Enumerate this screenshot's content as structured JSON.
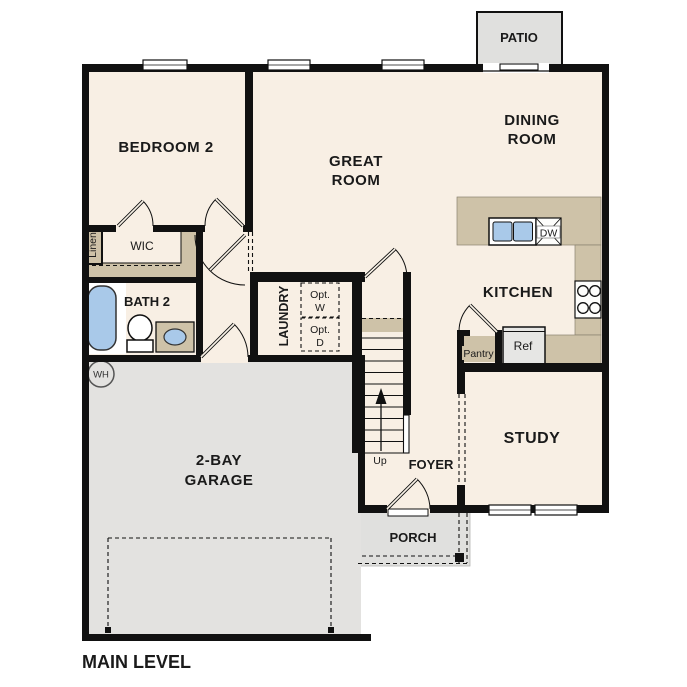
{
  "plan": {
    "title": "MAIN LEVEL",
    "level_count_note": "single visible level"
  },
  "labels": {
    "bedroom2": "BEDROOM 2",
    "great_1": "GREAT",
    "great_2": "ROOM",
    "dining_1": "DINING",
    "dining_2": "ROOM",
    "kitchen": "KITCHEN",
    "study": "STUDY",
    "foyer": "FOYER",
    "porch": "PORCH",
    "patio": "PATIO",
    "garage_1": "2-BAY",
    "garage_2": "GARAGE",
    "bath2": "BATH 2",
    "wic": "WIC",
    "linen": "Linen",
    "laundry": "LAUNDRY",
    "opt_w_1": "Opt.",
    "opt_w_2": "W",
    "opt_d_1": "Opt.",
    "opt_d_2": "D",
    "dw": "DW",
    "ref": "Ref",
    "pantry": "Pantry",
    "up": "Up",
    "wh": "WH",
    "main_level": "MAIN LEVEL"
  },
  "colors": {
    "floor_cream": "#f8efe4",
    "counter_tan": "#cec2a8",
    "garage_gray": "#e3e2e0",
    "outdoor_gray": "#e0e0de",
    "optional_gray": "#d9dddc",
    "fixture_blue": "#a9c9e9",
    "wall_black": "#111111"
  },
  "fixtures": [
    "tub",
    "toilet",
    "vanity-sink",
    "kitchen-sink",
    "dishwasher",
    "stove",
    "refrigerator",
    "water-heater",
    "stairs-up"
  ]
}
